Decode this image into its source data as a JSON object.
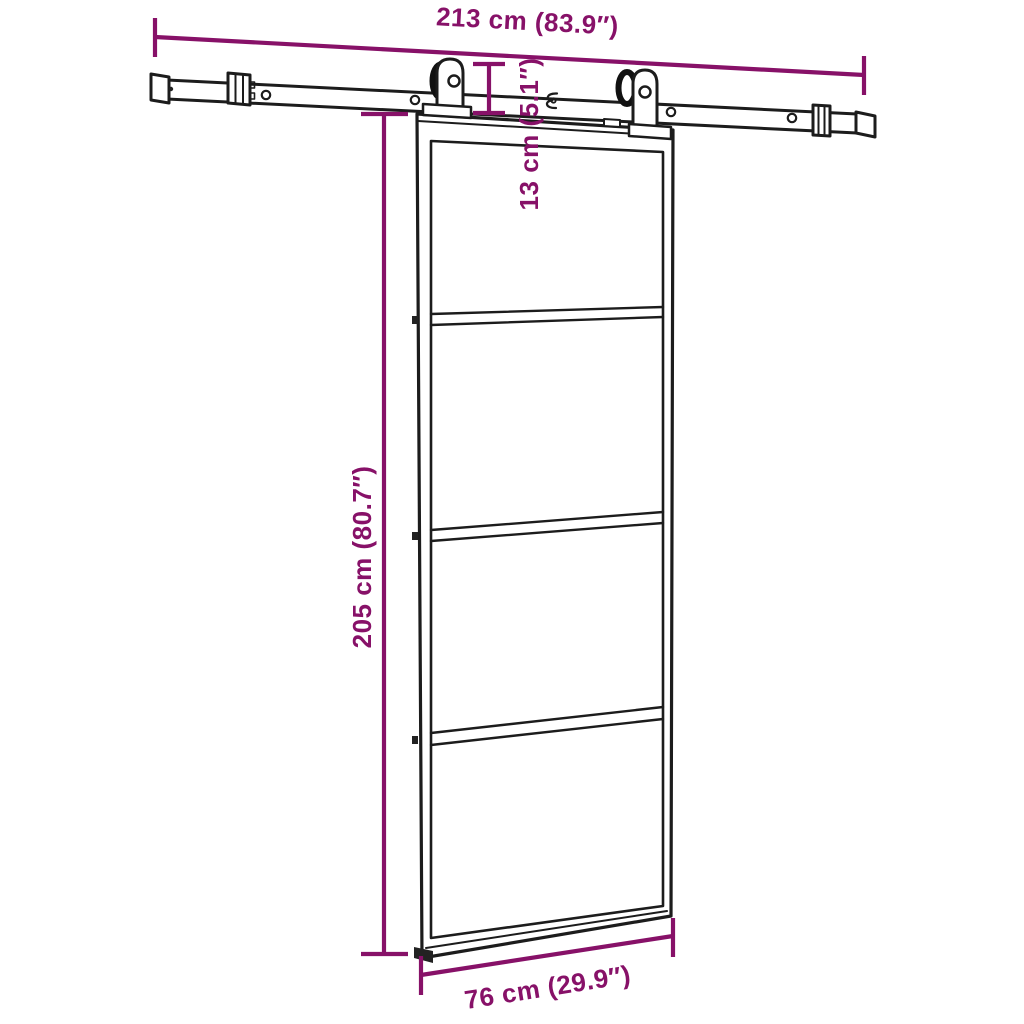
{
  "diagram": {
    "description": "Sliding barn door with top-mount track, two roller hangers and a 4-panel glass door, annotated with product dimensions",
    "background_color": "#ffffff",
    "line_color": "#1c1c1c",
    "annotation_color": "#871168",
    "door": {
      "panel_count": 4
    },
    "dimensions": {
      "track_length": {
        "label": "213 cm (83.9″)"
      },
      "door_top_offset": {
        "label": "13 cm (5.1″)"
      },
      "door_height": {
        "label": "205 cm (80.7″)"
      },
      "door_width": {
        "label": "76 cm (29.9″)"
      }
    }
  }
}
